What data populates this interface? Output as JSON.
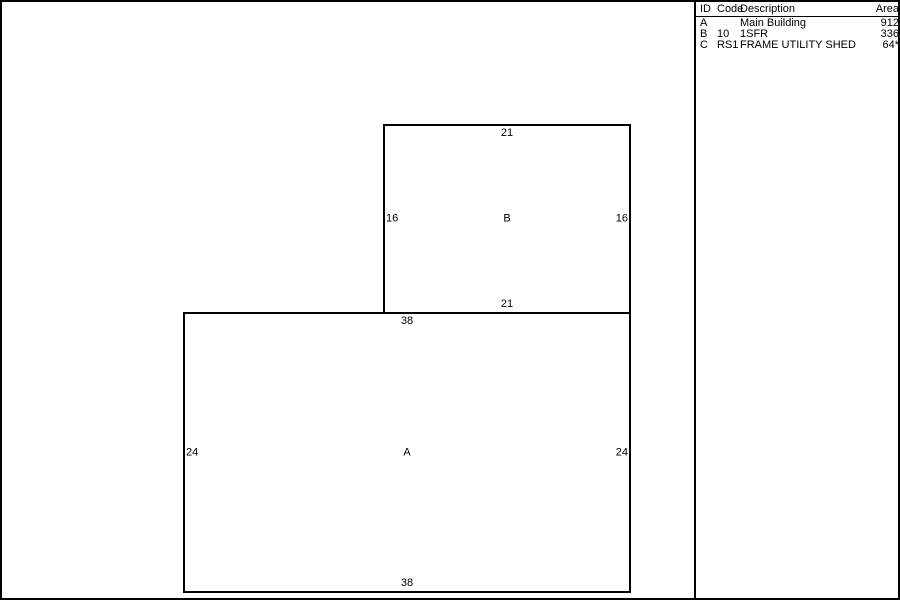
{
  "colors": {
    "line": "#000000",
    "background": "#ffffff",
    "text": "#000000"
  },
  "legend": {
    "headers": {
      "id": "ID",
      "code": "Code",
      "description": "Description",
      "area": "Area"
    },
    "rows": [
      {
        "id": "A",
        "code": "",
        "description": "Main Building",
        "area": "912"
      },
      {
        "id": "B",
        "code": "10",
        "description": "1SFR",
        "area": "336"
      },
      {
        "id": "C",
        "code": "RS1",
        "description": "FRAME UTILITY SHED",
        "area": "64*"
      }
    ]
  },
  "sketch": {
    "buildings": [
      {
        "label": "A",
        "dim_top": "38",
        "dim_bottom": "38",
        "dim_left": "24",
        "dim_right": "24"
      },
      {
        "label": "B",
        "dim_top": "21",
        "dim_bottom": "21",
        "dim_left": "16",
        "dim_right": "16"
      }
    ]
  }
}
